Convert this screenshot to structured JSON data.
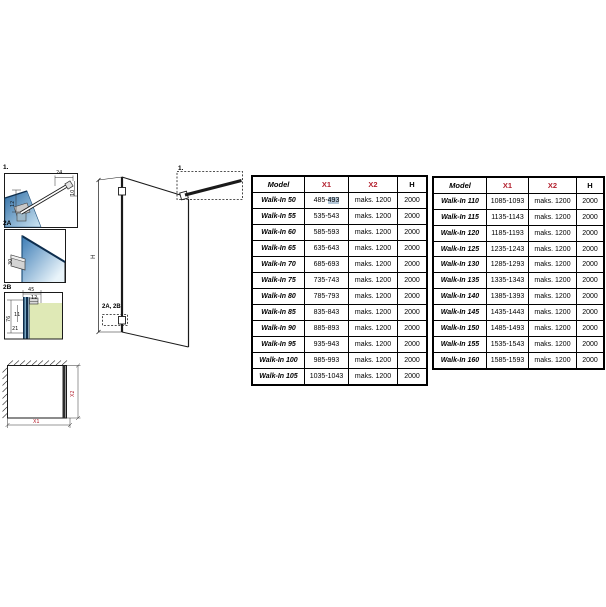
{
  "page": {
    "background": "#ffffff"
  },
  "colors": {
    "accent_red": "#b3202e",
    "selection_highlight": "#b4c7d8",
    "line": "#1a1a1a",
    "glass_dark": "#2f6ea6",
    "glass_light": "#d8ecf7",
    "wall_green": "#dfe9b6",
    "metal_gray": "#c9c9c9"
  },
  "drawings": {
    "detail_1": {
      "label": "1.",
      "dim_top": "24",
      "dim_right": "10",
      "dim_left": "12"
    },
    "detail_2a": {
      "label": "2A",
      "dim_bracket": "30"
    },
    "detail_2b": {
      "label": "2B",
      "dim_top": "45",
      "dim_top_inner": "12",
      "dim_left": "76",
      "dim_mid": "11",
      "dim_bottom": "21"
    },
    "elevation": {
      "dim_height": "H",
      "callout_top": "1.",
      "callout_bottom": "2A, 2B"
    },
    "plan": {
      "dim_width": "X1",
      "dim_depth": "X2"
    }
  },
  "tables": [
    {
      "name": "walk-in-sizes-50-105",
      "headers": [
        {
          "label": "Model",
          "color": "#000000"
        },
        {
          "label": "X1",
          "color": "#b3202e"
        },
        {
          "label": "X2",
          "color": "#b3202e"
        },
        {
          "label": "H",
          "color": "#000000"
        }
      ],
      "rows": [
        {
          "model": "Walk-In 50",
          "x1": "485-493",
          "x1_prefix": "485-",
          "x1_highlight": "493",
          "x2": "maks. 1200",
          "h": "2000"
        },
        {
          "model": "Walk-In 55",
          "x1": "535-543",
          "x2": "maks. 1200",
          "h": "2000"
        },
        {
          "model": "Walk-In 60",
          "x1": "585-593",
          "x2": "maks. 1200",
          "h": "2000"
        },
        {
          "model": "Walk-In 65",
          "x1": "635-643",
          "x2": "maks. 1200",
          "h": "2000"
        },
        {
          "model": "Walk-In 70",
          "x1": "685-693",
          "x2": "maks. 1200",
          "h": "2000"
        },
        {
          "model": "Walk-In 75",
          "x1": "735-743",
          "x2": "maks. 1200",
          "h": "2000"
        },
        {
          "model": "Walk-In 80",
          "x1": "785-793",
          "x2": "maks. 1200",
          "h": "2000"
        },
        {
          "model": "Walk-In 85",
          "x1": "835-843",
          "x2": "maks. 1200",
          "h": "2000"
        },
        {
          "model": "Walk-In 90",
          "x1": "885-893",
          "x2": "maks. 1200",
          "h": "2000"
        },
        {
          "model": "Walk-In 95",
          "x1": "935-943",
          "x2": "maks. 1200",
          "h": "2000"
        },
        {
          "model": "Walk-In 100",
          "x1": "985-993",
          "x2": "maks. 1200",
          "h": "2000"
        },
        {
          "model": "Walk-In 105",
          "x1": "1035-1043",
          "x2": "maks. 1200",
          "h": "2000"
        }
      ]
    },
    {
      "name": "walk-in-sizes-110-160",
      "headers": [
        {
          "label": "Model",
          "color": "#000000"
        },
        {
          "label": "X1",
          "color": "#b3202e"
        },
        {
          "label": "X2",
          "color": "#b3202e"
        },
        {
          "label": "H",
          "color": "#000000"
        }
      ],
      "rows": [
        {
          "model": "Walk-In 110",
          "x1": "1085-1093",
          "x2": "maks. 1200",
          "h": "2000"
        },
        {
          "model": "Walk-In 115",
          "x1": "1135-1143",
          "x2": "maks. 1200",
          "h": "2000"
        },
        {
          "model": "Walk-In 120",
          "x1": "1185-1193",
          "x2": "maks. 1200",
          "h": "2000"
        },
        {
          "model": "Walk-In 125",
          "x1": "1235-1243",
          "x2": "maks. 1200",
          "h": "2000"
        },
        {
          "model": "Walk-In 130",
          "x1": "1285-1293",
          "x2": "maks. 1200",
          "h": "2000"
        },
        {
          "model": "Walk-In 135",
          "x1": "1335-1343",
          "x2": "maks. 1200",
          "h": "2000"
        },
        {
          "model": "Walk-In 140",
          "x1": "1385-1393",
          "x2": "maks. 1200",
          "h": "2000"
        },
        {
          "model": "Walk-In 145",
          "x1": "1435-1443",
          "x2": "maks. 1200",
          "h": "2000"
        },
        {
          "model": "Walk-In 150",
          "x1": "1485-1493",
          "x2": "maks. 1200",
          "h": "2000"
        },
        {
          "model": "Walk-In 155",
          "x1": "1535-1543",
          "x2": "maks. 1200",
          "h": "2000"
        },
        {
          "model": "Walk-In 160",
          "x1": "1585-1593",
          "x2": "maks. 1200",
          "h": "2000"
        }
      ]
    }
  ]
}
